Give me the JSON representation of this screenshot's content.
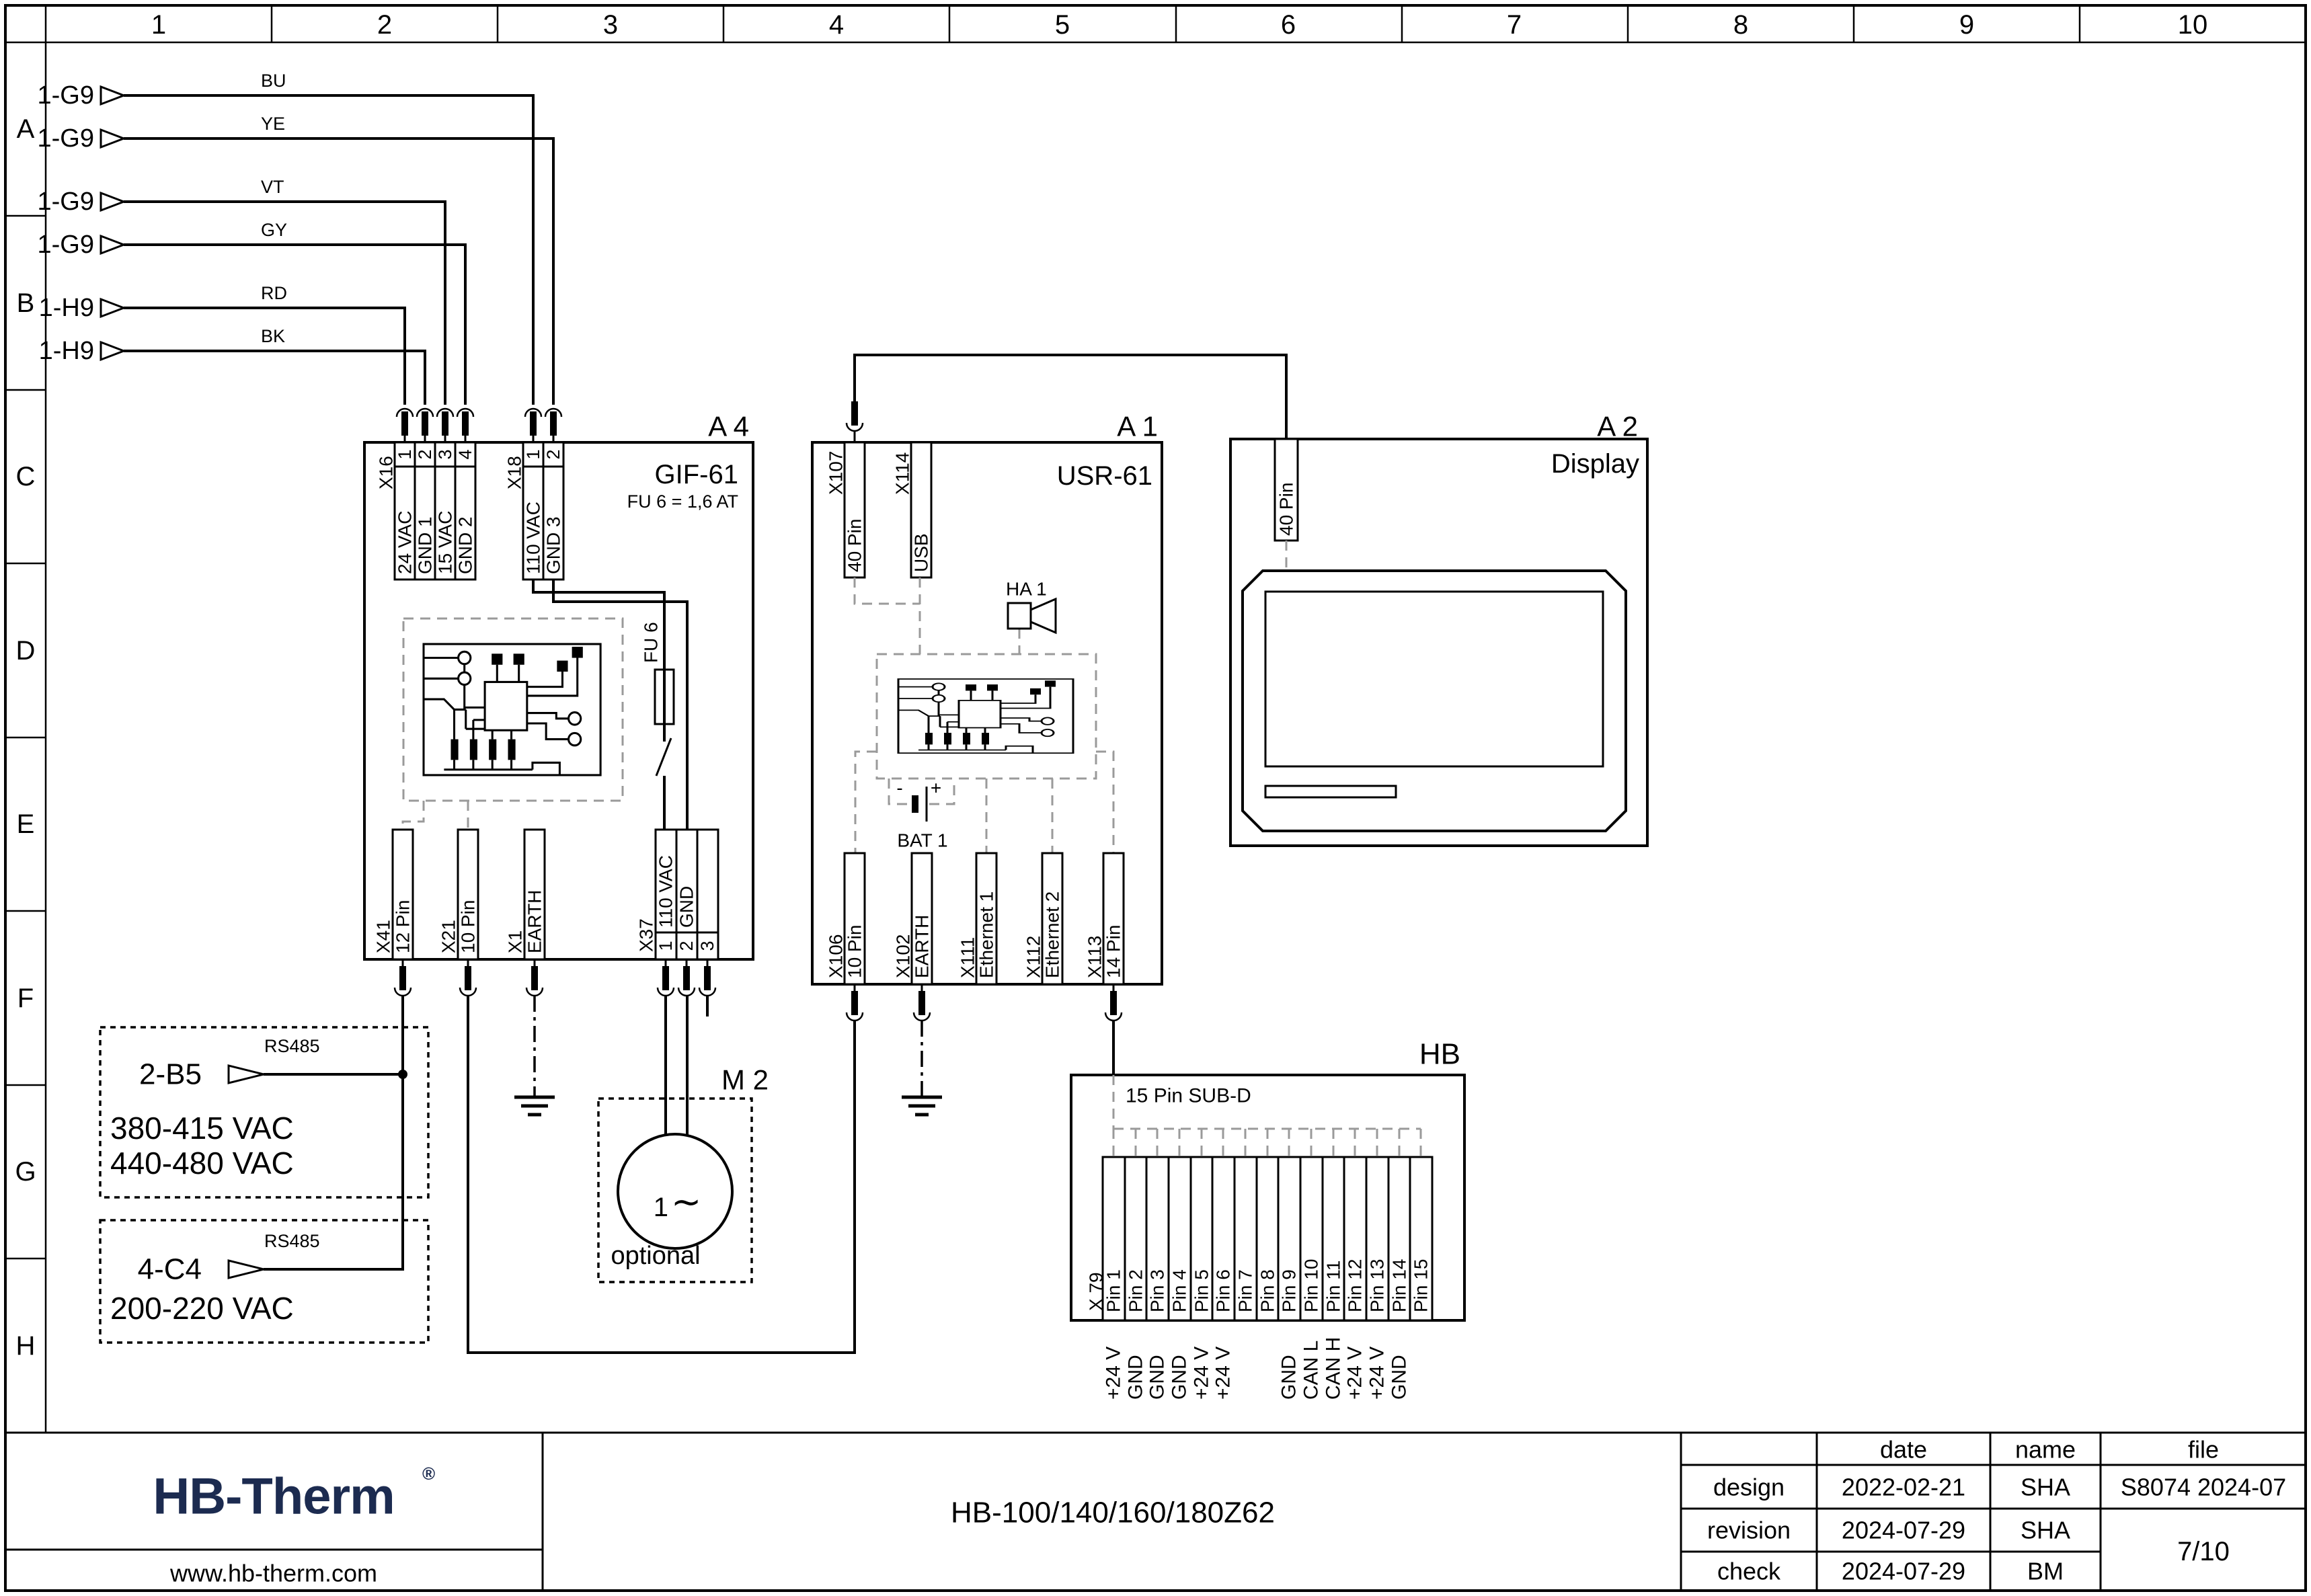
{
  "grid": {
    "columns": [
      "1",
      "2",
      "3",
      "4",
      "5",
      "6",
      "7",
      "8",
      "9",
      "10"
    ],
    "rows": [
      "A",
      "B",
      "C",
      "D",
      "E",
      "F",
      "G",
      "H"
    ]
  },
  "inputs": [
    {
      "tag": "1-G9",
      "code": "BU"
    },
    {
      "tag": "1-G9",
      "code": "YE"
    },
    {
      "tag": "1-G9",
      "code": "VT"
    },
    {
      "tag": "1-G9",
      "code": "GY"
    },
    {
      "tag": "1-H9",
      "code": "RD"
    },
    {
      "tag": "1-H9",
      "code": "BK"
    }
  ],
  "blocks": {
    "a4": {
      "ref": "A 4",
      "title": "GIF-61",
      "fuse_note": "FU 6 = 1,6 AT",
      "fuse": "FU 6",
      "x16": {
        "id": "X16",
        "pins": [
          "1",
          "2",
          "3",
          "4"
        ],
        "labels": [
          "24 VAC",
          "GND 1",
          "15 VAC",
          "GND 2"
        ]
      },
      "x18": {
        "id": "X18",
        "pins": [
          "1",
          "2"
        ],
        "labels": [
          "110 VAC",
          "GND 3"
        ]
      },
      "x41": {
        "id": "X41",
        "label": "12 Pin"
      },
      "x21": {
        "id": "X21",
        "label": "10 Pin"
      },
      "x1": {
        "id": "X1",
        "label": "EARTH"
      },
      "x37": {
        "id": "X37",
        "pins": [
          "1",
          "2",
          "3"
        ],
        "labels": [
          "110 VAC",
          "GND",
          ""
        ]
      }
    },
    "a1": {
      "ref": "A 1",
      "title": "USR-61",
      "x107": {
        "id": "X107",
        "label": "40 Pin"
      },
      "x114": {
        "id": "X114",
        "label": "USB"
      },
      "ha1": {
        "id": "HA 1"
      },
      "bat1": {
        "id": "BAT 1",
        "plus": "+",
        "minus": "-"
      },
      "x106": {
        "id": "X106",
        "label": "10 Pin"
      },
      "x102": {
        "id": "X102",
        "label": "EARTH"
      },
      "x111": {
        "id": "X111",
        "label": "Ethernet 1"
      },
      "x112": {
        "id": "X112",
        "label": "Ethernet 2"
      },
      "x113": {
        "id": "X113",
        "label": "14 Pin"
      }
    },
    "a2": {
      "ref": "A 2",
      "title": "Display",
      "conn": {
        "label": "40 Pin"
      }
    },
    "m2": {
      "ref": "M 2",
      "phase": "1",
      "wave": "∼",
      "note": "optional"
    },
    "hb": {
      "ref": "HB",
      "header": "15 Pin SUB-D",
      "id": "X 79",
      "pins": [
        "Pin 1",
        "Pin 2",
        "Pin 3",
        "Pin 4",
        "Pin 5",
        "Pin 6",
        "Pin 7",
        "Pin 8",
        "Pin 9",
        "Pin 10",
        "Pin 11",
        "Pin 12",
        "Pin 13",
        "Pin 14",
        "Pin 15"
      ],
      "signals": [
        "+24 V",
        "GND",
        "GND",
        "GND",
        "+24 V",
        "+24 V",
        "",
        "",
        "GND",
        "CAN L",
        "CAN H",
        "+24 V",
        "+24 V",
        "GND",
        ""
      ]
    }
  },
  "sources": [
    {
      "tag": "2-B5",
      "bus": "RS485",
      "volts": [
        "380-415 VAC",
        "440-480 VAC"
      ]
    },
    {
      "tag": "4-C4",
      "bus": "RS485",
      "volts": [
        "200-220 VAC"
      ]
    }
  ],
  "titleblock": {
    "logo": "HB-Therm",
    "reg": "®",
    "website": "www.hb-therm.com",
    "doc": "HB-100/140/160/180Z62",
    "col_date": "date",
    "col_name": "name",
    "col_file": "file",
    "rows": [
      {
        "label": "design",
        "date": "2022-02-21",
        "name": "SHA"
      },
      {
        "label": "revision",
        "date": "2024-07-29",
        "name": "SHA"
      },
      {
        "label": "check",
        "date": "2024-07-29",
        "name": "BM"
      }
    ],
    "file_no": "S8074 2024-07",
    "page": "7/10"
  }
}
